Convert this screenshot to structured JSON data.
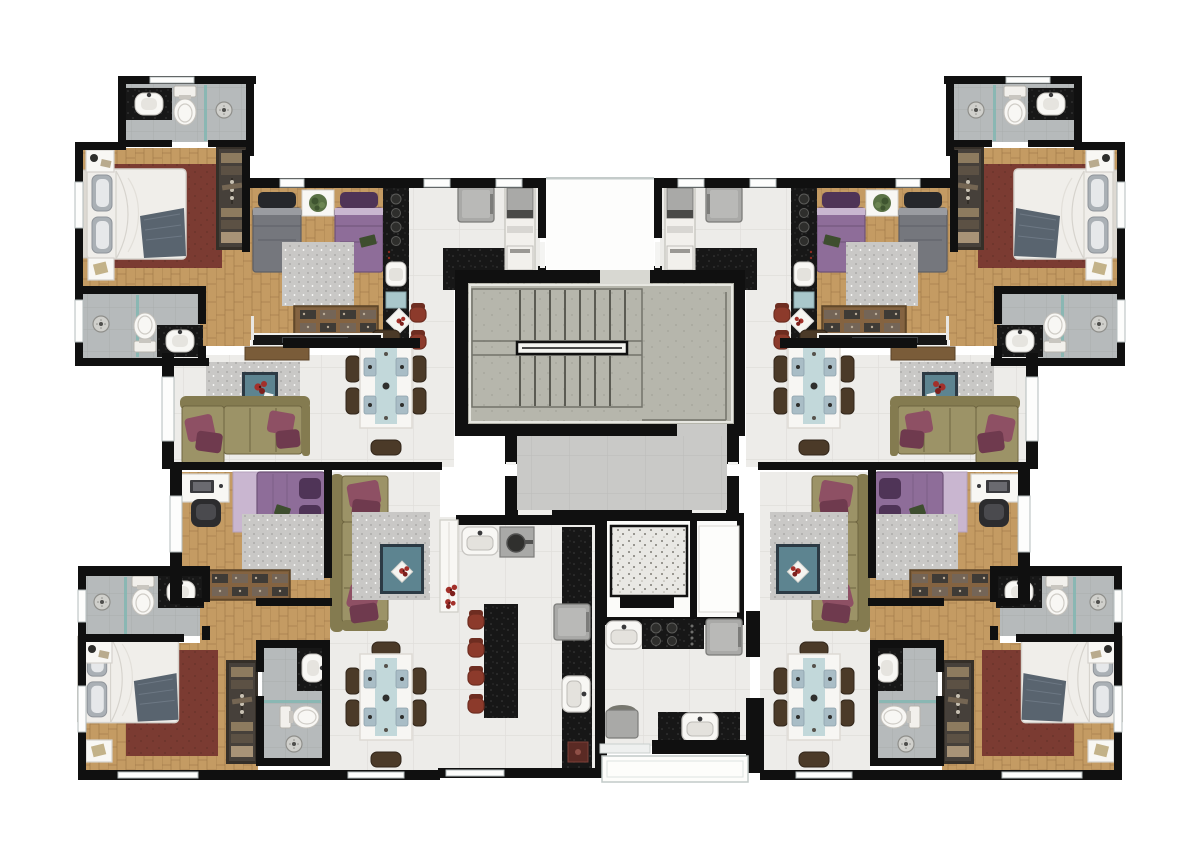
{
  "document": {
    "kind": "architectural-floor-plan",
    "description": "typical floor plan of a residential building, four corner apartments around a central stairwell, hall and elevator",
    "visible_text": []
  },
  "plan": {
    "common_areas": [
      "entry-corridor",
      "stairwell",
      "hall",
      "elevator",
      "service-shaft",
      "balcony"
    ],
    "unit_rooms": [
      "bathroom-suite",
      "master-bedroom",
      "bathroom-social",
      "twin-bedroom",
      "kitchen",
      "laundry-nook",
      "living-room",
      "dining-room",
      "desk-bedroom",
      "wardrobe-corridor"
    ],
    "furniture": [
      "double-bed",
      "twin-bed",
      "purple-bed",
      "wardrobe",
      "shoe-dresser",
      "nightstand",
      "pouf",
      "sofa-l-shape",
      "gray-rug",
      "red-rug",
      "coffee-table",
      "dining-table-six-chairs",
      "tv-panel",
      "console",
      "desk-with-chair",
      "kitchen-counter",
      "cooktop",
      "sink",
      "dishwasher",
      "washer-column",
      "fridge",
      "island-with-stools",
      "oven",
      "toilet",
      "vanity-sink",
      "shower-head",
      "white-cabinet",
      "plant",
      "flowers"
    ]
  },
  "palette": {
    "wall": "#101010",
    "exterior": "#ffffff",
    "tile": "#edece9",
    "tileLine": "#e0dedb",
    "hall": "#c9c9c7",
    "hallLine": "#bdbdbb",
    "bath": "#b6babb",
    "bathLine": "#a9adae",
    "tealAccent": "#7fb7b2",
    "wood": "#c49b63",
    "woodLine": "#ac8452",
    "woodDark": "#9b7443",
    "concrete": "#b6b6ac",
    "concreteDot": "#a8a89e",
    "concreteLine": "#8f8f87",
    "tread": "#5b5b53",
    "rail": "#f4f4f0",
    "rug": "#c9c8c6",
    "rugDot": "#a3a2a0",
    "redRug": "#7b3b32",
    "redRugDot": "#6b332b",
    "granite": "#171717",
    "graniteDot": "#3e3e3e",
    "olive": "#9c9367",
    "oliveDark": "#847b50",
    "oliveSeam": "#6e6540",
    "plum": "#8e5064",
    "plumDark": "#6f3a4e",
    "teal": "#5d8490",
    "tealBorder": "#2c3a44",
    "flowerRed": "#a3302a",
    "offWhite": "#f2f0ec",
    "whiteFurn": "#f8f7f4",
    "gray1": "#a9a9a7",
    "gray2": "#8b8b89",
    "appBorder": "#7c7c7a",
    "darkA": "#39393b",
    "bedWhite": "#f0eeea",
    "bedShadow": "#d6d3cd",
    "pillowGray": "#aab0b5",
    "throw": "#59646f",
    "purple": "#8e6d99",
    "purpleDark": "#4f3457",
    "lilac": "#c9b6d0",
    "grayBed": "#75777d",
    "grayBedLine": "#5d5f66",
    "blackPillow": "#25272b",
    "wardrobe": "#352f28",
    "wardInner": "#46403a",
    "item1": "#8d7b5f",
    "item2": "#5c5144",
    "item3": "#a89377",
    "hanger": "#c8c1b3",
    "brown": "#7a5c39",
    "brownDark": "#5a4226",
    "chairBrown": "#4b3a28",
    "tableWhite": "#f7f6f3",
    "runner": "#c2d8da",
    "setting": "#a9bdc6",
    "stoolRed": "#8c3a2b",
    "stoolDark": "#6e2d21",
    "plant": "#5a7245",
    "plantDark": "#3f5530",
    "book": "#3e4e2f",
    "blueRack": "#a9c7cb",
    "speckBg": "#e9e8e4",
    "speckDot": "#5f5c54",
    "screen": "#3f4347",
    "winLine": "#b4bcbc",
    "balcony": "#c2cac8"
  }
}
